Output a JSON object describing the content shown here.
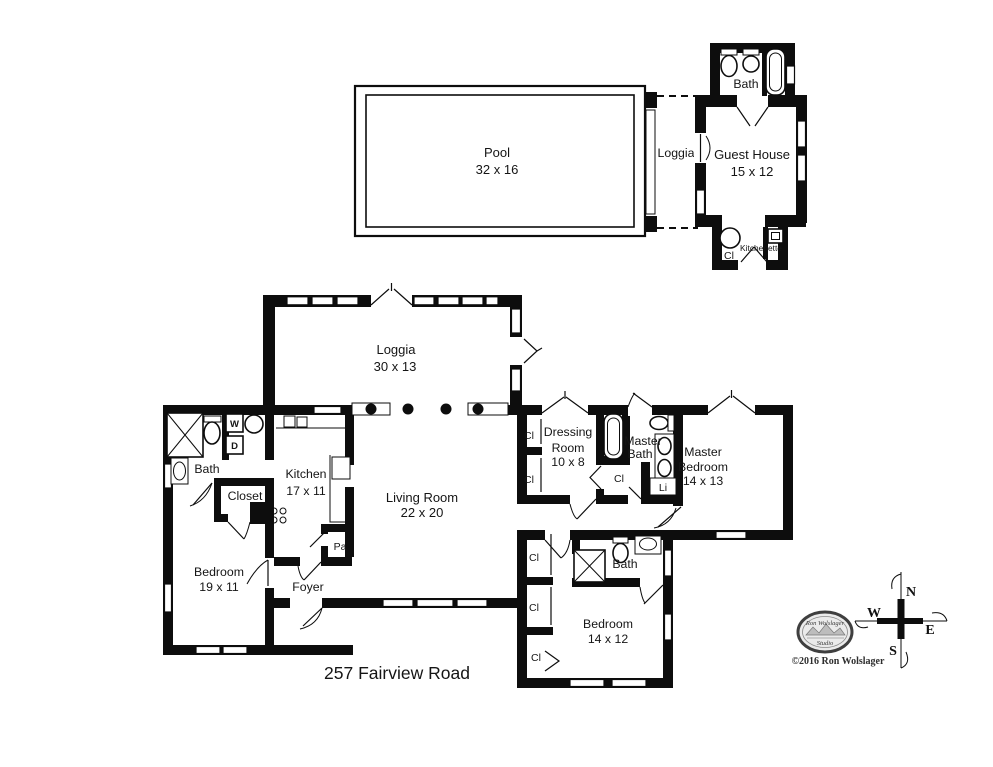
{
  "address": "257 Fairview Road",
  "copyright": "©2016 Ron Wolslager",
  "logo": {
    "name": "Ron Wolslager",
    "sub": "Studio"
  },
  "compass": {
    "n": "N",
    "w": "W",
    "e": "E",
    "s": "S"
  },
  "labels": {
    "cl": "Cl",
    "bath": "Bath",
    "li": "Li",
    "pa": "Pa",
    "washer": "W",
    "dryer": "D",
    "closet": "Closet",
    "foyer": "Foyer",
    "kitchenette": "Kitchenette"
  },
  "rooms": {
    "pool": {
      "name": "Pool",
      "dims": "32 x 16"
    },
    "pool_loggia": {
      "name": "Loggia"
    },
    "guest_house": {
      "name": "Guest House",
      "dims": "15 x 12"
    },
    "loggia": {
      "name": "Loggia",
      "dims": "30 x 13"
    },
    "living_room": {
      "name": "Living Room",
      "dims": "22 x 20"
    },
    "kitchen": {
      "name": "Kitchen",
      "dims": "17 x 11"
    },
    "bedroom_left": {
      "name": "Bedroom",
      "dims": "19 x 11"
    },
    "dressing_room": {
      "name": "Dressing",
      "name2": "Room",
      "dims": "10 x 8"
    },
    "master_bath": {
      "name": "Master",
      "name2": "Bath"
    },
    "master_bedroom": {
      "name": "Master",
      "name2": "Bedroom",
      "dims": "14 x 13"
    },
    "bedroom_right": {
      "name": "Bedroom",
      "dims": "14 x 12"
    }
  }
}
